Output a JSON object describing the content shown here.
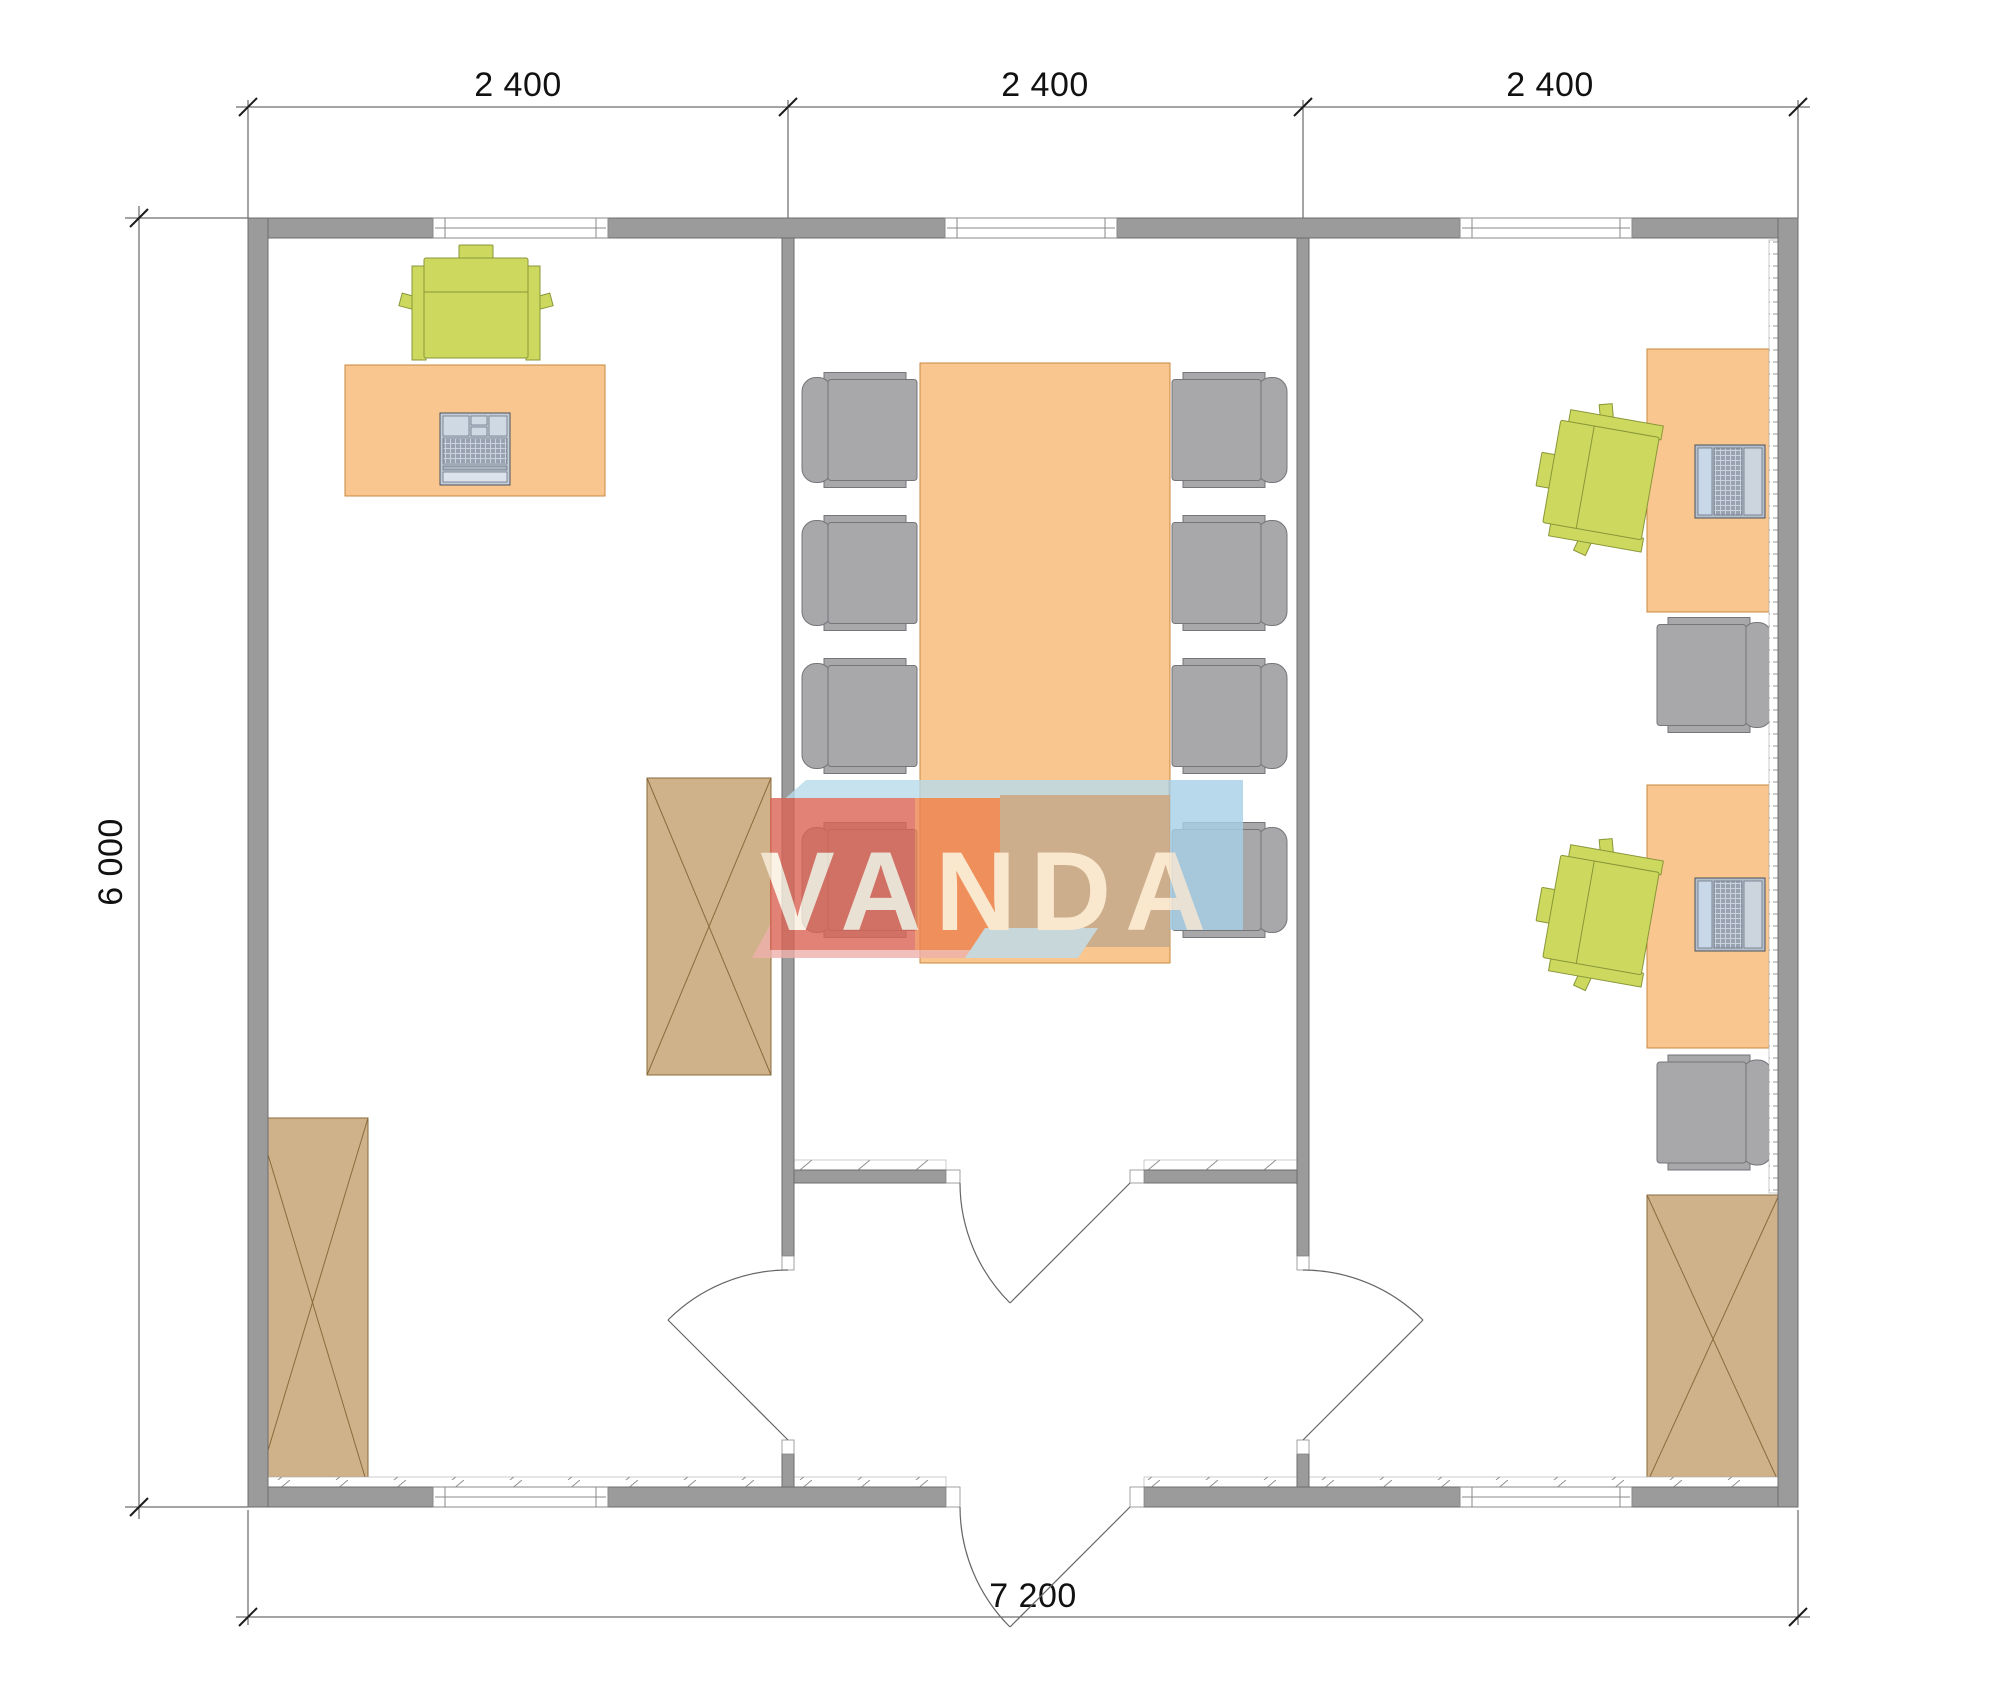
{
  "title": "Office floor plan",
  "dimensions": {
    "top_segments": [
      "2 400",
      "2 400",
      "2 400"
    ],
    "left_total": "6 000",
    "bottom_total": "7 200"
  },
  "watermark": {
    "text": "VANDA"
  },
  "colors": {
    "wall": "#9b9b9b",
    "desk": "#f8c68e",
    "chair_green": "#ccd95e",
    "chair_gray": "#a8a8aa",
    "cabinet": "#cfb289",
    "logo_red": "#dc6354",
    "logo_orange": "#ee8350",
    "logo_blue_top": "#b9dcec",
    "logo_blue_right": "#a7cfe8",
    "logo_tan": "#c2a88c",
    "logo_pink": "#f0b1ac"
  }
}
